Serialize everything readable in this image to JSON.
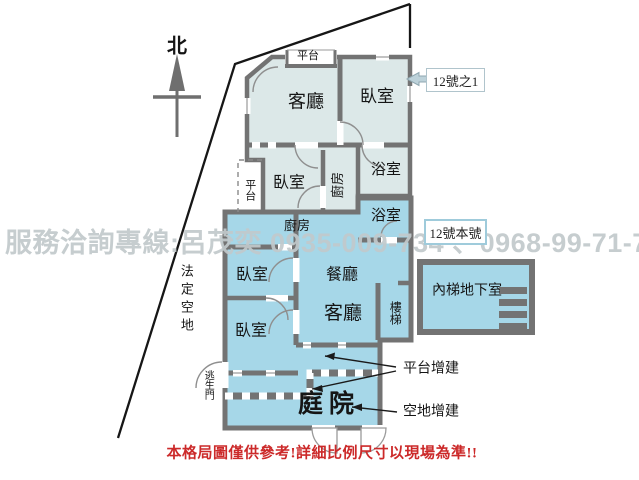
{
  "colors": {
    "upper_unit_fill": "#dce8e8",
    "lower_unit_fill": "#a6d7e8",
    "wall": "#737373",
    "boundary_line": "#161616",
    "disclaimer_red": "#cc2a2a",
    "watermark_gray": "#c1c9cb",
    "tag_border_blue": "#9fcbdb"
  },
  "north_label": "北",
  "watermark_text": "服務洽詢專線:呂茂奕 0935-009-734 、0968-99-71-75",
  "disclaimer_text": "本格局圖僅供參考!詳細比例尺寸以現場為準!!",
  "tags": {
    "unit_1": "12號之1",
    "unit_main": "12號本號"
  },
  "rooms": {
    "platform_top": "平台",
    "living_upper": "客廳",
    "bedroom_upper": "臥室",
    "bath_upper": "浴室",
    "bath_lower": "浴室",
    "kitchen_upper": "廚房",
    "bedroom_mid": "臥室",
    "platform_left": "平台",
    "kitchen_lower": "廚房",
    "dining": "餐廳",
    "living_lower": "客廳",
    "bedroom_lower_1": "臥室",
    "bedroom_lower_2": "臥室",
    "stairs": "樓梯",
    "basement": "內梯地下室",
    "courtyard": "庭院",
    "escape_door": "逃生門",
    "legal_open_space": "法定空地"
  },
  "annotations": {
    "platform_addition": "平台增建",
    "open_space_addition": "空地增建"
  }
}
